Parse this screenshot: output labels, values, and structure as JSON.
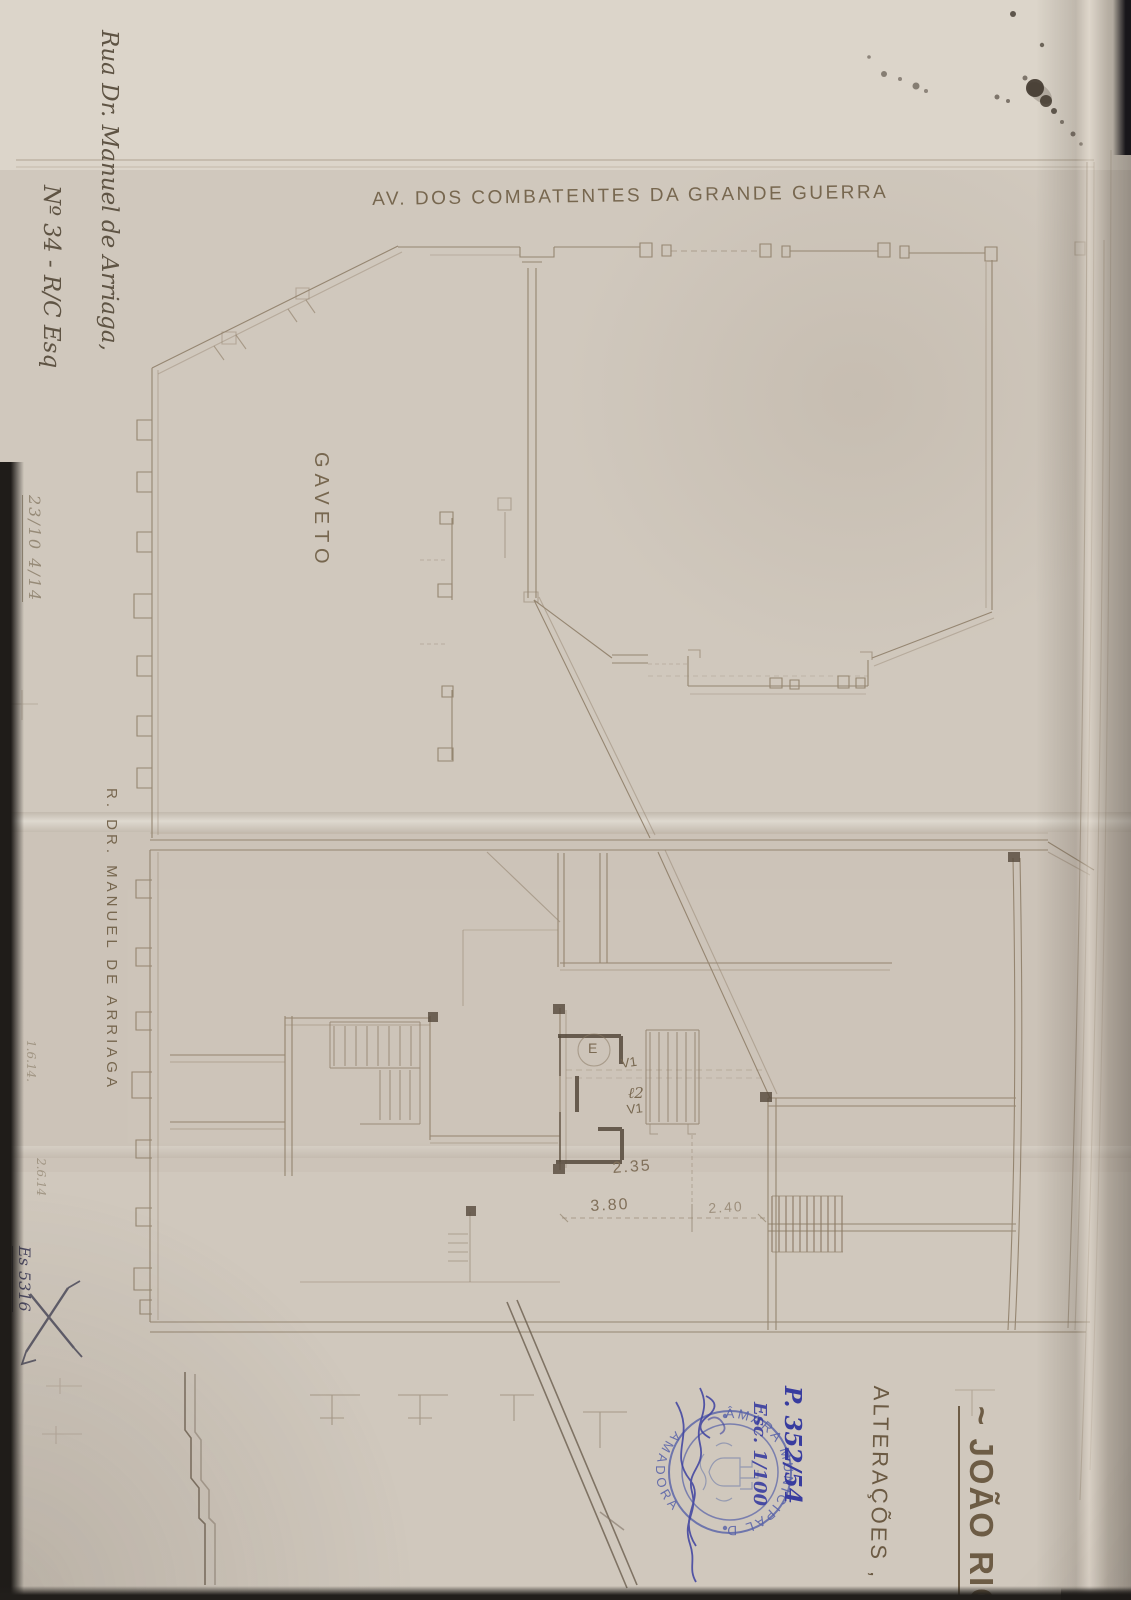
{
  "photo": {
    "paper_color": "#d0c8bd",
    "pencil_color": "#8b7a64",
    "heavy_wall_color": "#55493b",
    "ink_blue": "#3c40a0",
    "stamp_blue": "#5560a8",
    "ink_blot_color": "#3f362c"
  },
  "plan": {
    "street_top": "AV. DOS COMBATENTES DA GRANDE GUERRA",
    "street_left": "R. DR. MANUEL DE ARRIAGA",
    "corner_label": "GAVETO",
    "room_labels": {
      "entry": "E",
      "v_upper": "V1",
      "door": "ℓ2",
      "v_lower": "V1"
    },
    "dimensions": {
      "hall_depth": "2.35",
      "span_left": "3.80",
      "span_right": "2.40"
    }
  },
  "annotations": {
    "address_line1": "Rua Dr. Manuel de Arriaga,",
    "address_line2": "Nº 34 - R/C Esq",
    "title_applicant": "~ JOÃO RIC",
    "title_subject": "ALTERAÇÕES ,",
    "process_number": "P. 352/54",
    "scale_note": "Esc. 1/100",
    "margin_date": "23/10 4/14",
    "margin_note_1": "1.6.14.",
    "margin_note_2": "2.6.14",
    "margin_ref": "Es 5316"
  },
  "stamp": {
    "arc_top": "CÂMARA MUNICIPAL DA",
    "arc_bottom": "AMADORA"
  }
}
